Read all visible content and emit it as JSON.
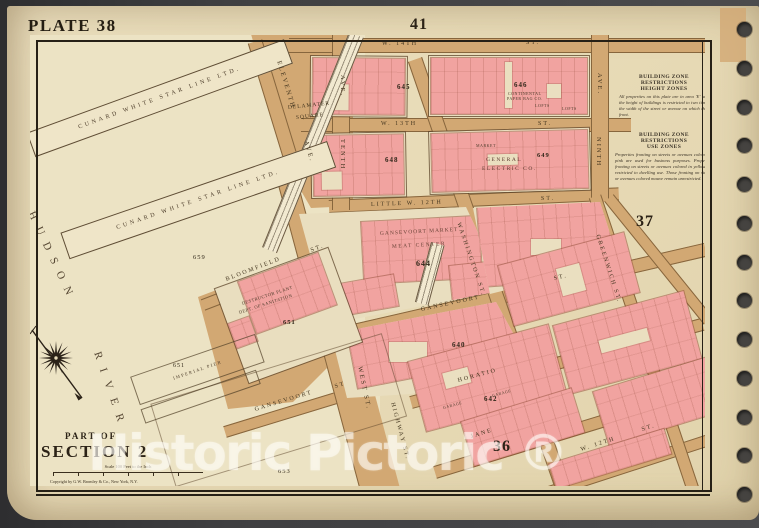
{
  "photo": {
    "background": "#3a3a3c"
  },
  "colors": {
    "paper": "#e8dcba",
    "water": "#ece3c4",
    "street_tan": "#d2a873",
    "block_cream": "#e9debf",
    "building_pink": "#f1a3a0",
    "ink": "#2b2218",
    "watermark_white": "rgba(255,255,255,0.55)"
  },
  "plate": {
    "title": "PLATE 38",
    "top_ref": "41",
    "right_ref": "37",
    "bottom_ref": "36"
  },
  "corner": {
    "part_of": "PART OF",
    "section": "SECTION 2",
    "scale": "Scale 100 Feet to the Inch",
    "copyright": "Copyright by G.W. Bromley & Co., New York, N.Y."
  },
  "river": {
    "word1": "HUDSON",
    "word2": "RIVER"
  },
  "piers": {
    "cunard1": "CUNARD WHITE STAR LINE LTD.",
    "cunard2": "CUNARD WHITE STAR LINE LTD.",
    "imperial": "IMPERIAL PIER"
  },
  "streets": {
    "w14": "W. 14TH",
    "w13": "W. 13TH",
    "lw12": "LITTLE W. 12TH",
    "st": "ST.",
    "st_plain": "ST",
    "gansevoort": "GANSEVOORT",
    "horatio": "HORATIO",
    "jane": "JANE",
    "w12": "W. 12TH",
    "eleventh": "ELEVENTH",
    "tenth": "TENTH",
    "ninth": "NINTH",
    "ave": "AVE.",
    "washington": "WASHINGTON ST.",
    "greenwich": "GREENWICH ST.",
    "west": "WEST ST.",
    "highway": "HIGHWAY ST.",
    "bloomfield": "BLOOMFIELD",
    "gansevoort_lower": "GANSEVOORT",
    "delamater1": "DELAMATER",
    "delamater2": "SQUARE"
  },
  "blocks": {
    "b644": "644",
    "b645": "645",
    "b646": "646",
    "b648": "648",
    "b649": "649",
    "b640": "640",
    "b642": "642",
    "b651": "651",
    "b653": "653",
    "b659": "659"
  },
  "buildings": {
    "market1": "GANSEVOORT MARKET",
    "market2": "MEAT CENTER",
    "ge1": "GENERAL",
    "ge2": "ELECTRIC CO.",
    "continental1": "CONTINENTAL",
    "continental2": "PAPER BAG CO.",
    "lofts": "LOFTS",
    "market_small": "MARKET",
    "garage": "GARAGE",
    "plant1": "DESTRUCTOR PLANT",
    "plant2": "DEPT. OF SANITATION"
  },
  "zone_notes": {
    "note1": {
      "line1": "BUILDING ZONE RESTRICTIONS",
      "line2": "HEIGHT ZONES",
      "body": "All properties on this plate are in area 'E' and the height of buildings is restricted to two times the width of the street or avenue on which they front."
    },
    "note2": {
      "line1": "BUILDING ZONE RESTRICTIONS",
      "line2": "USE ZONES",
      "body": "Properties fronting on streets or avenues colored in pink are used for business purposes. Properties fronting on streets or avenues colored in yellow are restricted to dwelling use. Those fronting on streets or avenues colored mauve remain unrestricted."
    }
  },
  "watermark": {
    "text": "Historic Pictoric ®"
  }
}
